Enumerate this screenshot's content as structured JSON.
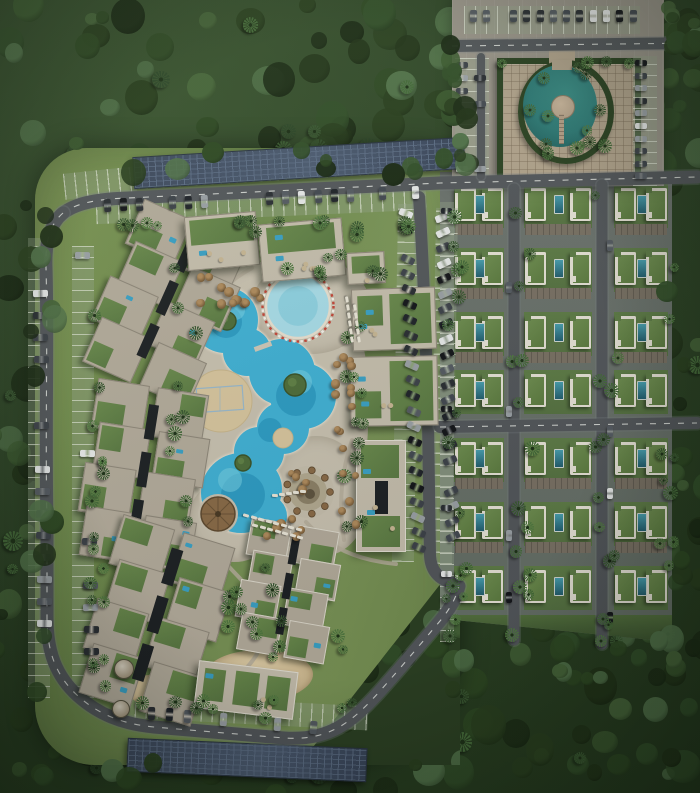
{
  "scene": {
    "width": 700,
    "height": 793
  },
  "palette": {
    "forest_tones": [
      "#223419",
      "#2a401f",
      "#33502a",
      "#3d5c31",
      "#1c2c16",
      "#47663a",
      "#52734a",
      "#2f4a24"
    ],
    "lawn": "#75904f",
    "deck": "#c9c2b1",
    "path": "#b6ae9c",
    "asphalt": "#54585c",
    "asphalt_edge": "#7c8084",
    "road_line": "#e4e6e2",
    "stall_base": "rgba(150,165,140,0.38)",
    "stall_line": "rgba(228,233,218,0.65)",
    "pool_main": "#41b2d6",
    "pool_deep": "#2794bd",
    "pool_light": "#79d2e6",
    "pool_kids": "#a9dde9",
    "pool_kids_deep": "#8fd2e2",
    "pool_rim": "#e9e1d1",
    "kids_ring_red": "#c4473a",
    "kids_ring_white": "#f4f1ea",
    "sand": "#d8c69f",
    "island_green": "#4f6e3b",
    "island_ring": "#3b5429",
    "court_line": "#8fb6d4",
    "roof_beige": "#b4ac9c",
    "roof_light": "#c6bfae",
    "roof_green": "#5b7a44",
    "core_dark": "#1e2225",
    "roof_pool": "#3ba2c6",
    "terrace_dot": "#c8b795",
    "villa_pool": "#2a7083",
    "pond": "#2f7c78",
    "hedge": "#2c4323",
    "plaza": "#b2a48d",
    "pavement": "#9b968b",
    "palapa_dark": "#5f4a30",
    "palapa_mid": "#8a6b48",
    "bar_outer": "#c6bfad",
    "bar_ring": "#b3aa91",
    "bar_inner": "#8d8168",
    "bar_center": "#5f5440",
    "car_colors": [
      "#15171b",
      "#2b2f34",
      "#3e434a",
      "#565c63",
      "#9ba1a6",
      "#e8eaea",
      "#20242a",
      "#444a52"
    ]
  },
  "forest": {
    "seed": 20240601,
    "count": 330,
    "palm_count": 70,
    "fringe_count": 90
  },
  "roads": {
    "paths": [
      {
        "name": "perimeter-top-road",
        "d": "M62,214 C74,204 94,199 128,198 L440,183 L697,177",
        "w": 13,
        "dash": true
      },
      {
        "name": "perimeter-west-south-road",
        "d": "M63,213 C50,224 45,242 46,268 C48,336 45,430 47,525 L47,618 C47,652 56,676 78,696 C98,714 122,724 154,727 L284,738 C330,741 352,722 380,691 C404,664 424,640 440,621 C450,609 456,598 459,586",
        "w": 13,
        "dash": true
      },
      {
        "name": "central-parking-street",
        "d": "M419,197 C423,260 426,340 428,420 L430,556 C431,570 438,579 452,583",
        "w": 12,
        "dash": false
      },
      {
        "name": "entrance-road",
        "d": "M452,46 L700,43",
        "w": 12,
        "dash": true
      },
      {
        "name": "entrance-connector",
        "d": "M481,57 L481,176",
        "w": 8,
        "dash": false
      },
      {
        "name": "villa-street-west",
        "d": "M514,189 L514,640",
        "w": 11,
        "dash": false
      },
      {
        "name": "villa-street-east",
        "d": "M602,185 L602,644",
        "w": 11,
        "dash": false
      },
      {
        "name": "villa-cross-road",
        "d": "M440,427 L697,423",
        "w": 12,
        "dash": true
      }
    ],
    "garden_paths": [
      {
        "d": "M212,545 C232,576 256,586 262,616 C268,642 256,660 240,674"
      },
      {
        "d": "M306,522 C330,548 356,560 396,564"
      },
      {
        "d": "M252,268 C230,280 214,296 206,314"
      },
      {
        "d": "M352,440 C342,470 338,500 344,540"
      },
      {
        "d": "M200,420 C184,440 180,470 190,498"
      }
    ]
  },
  "decks": [
    [
      168,
      262,
      200,
      300,
      "48% 42% 46% 52%"
    ],
    [
      252,
      258,
      118,
      96,
      "50%"
    ],
    [
      272,
      436,
      96,
      120,
      "46% 54% 48% 44%"
    ],
    [
      188,
      478,
      92,
      84,
      "50% 45% 50% 50%"
    ]
  ],
  "pool": {
    "lagoon": [
      [
        225,
        320,
        33
      ],
      [
        247,
        352,
        24
      ],
      [
        282,
        372,
        33
      ],
      [
        303,
        396,
        33
      ],
      [
        283,
        428,
        26
      ],
      [
        259,
        452,
        25
      ],
      [
        249,
        489,
        33
      ],
      [
        266,
        516,
        21
      ],
      [
        241,
        493,
        40
      ]
    ],
    "deep": [
      [
        296,
        396,
        20
      ],
      [
        243,
        495,
        22
      ],
      [
        226,
        322,
        16
      ],
      [
        270,
        430,
        12
      ]
    ],
    "light": [
      [
        235,
        310,
        10
      ],
      [
        300,
        382,
        12
      ],
      [
        230,
        480,
        12
      ]
    ],
    "islands": [
      [
        227,
        321,
        9
      ],
      [
        295,
        385,
        11
      ],
      [
        243,
        463,
        8
      ]
    ],
    "kids": {
      "cx": 298,
      "cy": 306,
      "r": 32,
      "ring_r": 35.5
    },
    "sand": {
      "cx": 221,
      "cy": 401,
      "r": 31
    },
    "court": [
      197,
      387,
      46,
      24
    ],
    "bridge": [
      254,
      344,
      18,
      5,
      -20
    ],
    "palapa": {
      "cx": 218,
      "cy": 514,
      "r": 17
    },
    "bar": {
      "cx": 308,
      "cy": 492,
      "umbrellas": 9,
      "umb_r": 22
    },
    "sand2": {
      "cx": 283,
      "cy": 438,
      "r": 10
    }
  },
  "apartment_clusters": [
    {
      "x": 104,
      "y": 216,
      "w": 122,
      "h": 174,
      "rot": 24,
      "trim": false
    },
    {
      "x": 84,
      "y": 386,
      "w": 118,
      "h": 178,
      "rot": 9,
      "trim": false
    },
    {
      "x": 94,
      "y": 528,
      "w": 124,
      "h": 184,
      "rot": 17,
      "trim": false
    },
    {
      "x": 240,
      "y": 524,
      "w": 94,
      "h": 132,
      "rot": 10,
      "trim": true
    }
  ],
  "slabs": [
    {
      "x": 186,
      "y": 214,
      "w": 70,
      "h": 52,
      "rot": -5,
      "green": [
        [
          0.05,
          0.05,
          0.9,
          0.48
        ]
      ],
      "pools": 1,
      "dots": 3,
      "trim": false
    },
    {
      "x": 260,
      "y": 221,
      "w": 82,
      "h": 56,
      "rot": -5,
      "green": [
        [
          0.08,
          0.05,
          0.84,
          0.46
        ]
      ],
      "pools": 2,
      "dots": 4,
      "trim": false
    },
    {
      "x": 347,
      "y": 252,
      "w": 36,
      "h": 30,
      "rot": -3,
      "green": [
        [
          0.1,
          0.1,
          0.8,
          0.55
        ]
      ],
      "pools": 0,
      "dots": 1,
      "trim": false
    },
    {
      "x": 352,
      "y": 288,
      "w": 82,
      "h": 60,
      "rot": -2,
      "green": [
        [
          0.45,
          0.08,
          0.5,
          0.84
        ],
        [
          0.06,
          0.1,
          0.3,
          0.5
        ]
      ],
      "pools": 2,
      "dots": 2,
      "trim": false
    },
    {
      "x": 350,
      "y": 356,
      "w": 86,
      "h": 68,
      "rot": -1,
      "green": [
        [
          0.45,
          0.06,
          0.5,
          0.88
        ],
        [
          0.05,
          0.5,
          0.3,
          0.4
        ]
      ],
      "pools": 2,
      "dots": 2,
      "trim": false
    },
    {
      "x": 356,
      "y": 440,
      "w": 48,
      "h": 110,
      "rot": 0,
      "green": [
        [
          0.08,
          0.04,
          0.8,
          0.3
        ],
        [
          0.1,
          0.68,
          0.8,
          0.28
        ]
      ],
      "core": [
        0.38,
        0.36,
        0.26,
        0.3
      ],
      "pools": 2,
      "dots": 2,
      "trim": true
    },
    {
      "x": 196,
      "y": 666,
      "w": 98,
      "h": 46,
      "rot": 7,
      "green": [
        [
          0.06,
          0.12,
          0.22,
          0.7
        ],
        [
          0.38,
          0.1,
          0.24,
          0.75
        ],
        [
          0.7,
          0.14,
          0.24,
          0.7
        ]
      ],
      "pools": 1,
      "dots": 2,
      "trim": true
    }
  ],
  "villa_grid": {
    "x": 440,
    "y": 172,
    "w": 232,
    "h": 470,
    "groups": [
      {
        "x": 14,
        "w": 50
      },
      {
        "x": 84,
        "w": 68
      },
      {
        "x": 174,
        "w": 54
      }
    ],
    "rows": [
      16,
      80,
      144,
      202,
      270,
      334,
      398
    ],
    "villa": {
      "w": 21,
      "h": 33
    },
    "bottom_strip_y": 443
  },
  "entrance": {
    "base": [
      452,
      0,
      212,
      186
    ],
    "plaza": [
      497,
      58,
      132,
      114
    ],
    "pond": [
      518,
      60,
      84,
      92
    ],
    "island": [
      551,
      95,
      22
    ],
    "pond_bridge": [
      559,
      114,
      5,
      30
    ],
    "gap": [
      549,
      50,
      26,
      16
    ]
  },
  "parking_bands": [
    {
      "x": 96,
      "y": 194,
      "w": 330,
      "h": 23,
      "rot": -2.5,
      "dir": 90
    },
    {
      "x": 64,
      "y": 170,
      "w": 72,
      "h": 26,
      "rot": -6,
      "dir": 90
    },
    {
      "x": 28,
      "y": 238,
      "w": 22,
      "h": 460,
      "rot": 0,
      "dir": 0
    },
    {
      "x": 72,
      "y": 246,
      "w": 22,
      "h": 452,
      "rot": 0,
      "dir": 0
    },
    {
      "x": 124,
      "y": 700,
      "w": 244,
      "h": 24,
      "rot": 3,
      "dir": 90
    },
    {
      "x": 395,
      "y": 204,
      "w": 22,
      "h": 358,
      "rot": 1,
      "dir": 0
    },
    {
      "x": 433,
      "y": 208,
      "w": 22,
      "h": 356,
      "rot": 1,
      "dir": 0
    },
    {
      "x": 464,
      "y": 6,
      "w": 176,
      "h": 28,
      "rot": 0,
      "dir": 90
    },
    {
      "x": 455,
      "y": 58,
      "w": 34,
      "h": 122,
      "rot": 0,
      "dir": 0
    },
    {
      "x": 633,
      "y": 56,
      "w": 24,
      "h": 130,
      "rot": 0,
      "dir": 0
    },
    {
      "x": 440,
      "y": 202,
      "w": 14,
      "h": 440,
      "rot": 0,
      "dir": 0
    }
  ],
  "car_strips": [
    {
      "x": 104,
      "y": 199,
      "dx": 16.2,
      "dy": -0.7,
      "n": 20,
      "w": 7,
      "h": 13,
      "rot": -3,
      "p": 0.8
    },
    {
      "x": 399,
      "y": 210,
      "dx": 0.6,
      "dy": 15.2,
      "n": 23,
      "w": 14,
      "h": 6.5,
      "rot": 24,
      "p": 0.85
    },
    {
      "x": 435,
      "y": 214,
      "dx": 0.5,
      "dy": 15.2,
      "n": 22,
      "w": 14,
      "h": 6.5,
      "rot": -24,
      "p": 0.8
    },
    {
      "x": 32,
      "y": 246,
      "dx": 0.3,
      "dy": 22,
      "n": 20,
      "w": 15,
      "h": 7,
      "rot": 0,
      "p": 0.5
    },
    {
      "x": 75,
      "y": 252,
      "dx": 0.5,
      "dy": 22,
      "n": 19,
      "w": 15,
      "h": 7,
      "rot": 0,
      "p": 0.4
    },
    {
      "x": 130,
      "y": 705,
      "dx": 18,
      "dy": 1.6,
      "n": 13,
      "w": 7,
      "h": 13,
      "rot": 4,
      "p": 0.65
    },
    {
      "x": 470,
      "y": 10,
      "dx": 13.3,
      "dy": 0,
      "n": 13,
      "w": 6.5,
      "h": 12,
      "rot": 0,
      "p": 0.8
    },
    {
      "x": 456,
      "y": 62,
      "dx": 0,
      "dy": 13,
      "n": 9,
      "w": 12,
      "h": 6,
      "rot": 0,
      "p": 0.75
    },
    {
      "x": 474,
      "y": 62,
      "dx": 0,
      "dy": 13,
      "n": 9,
      "w": 12,
      "h": 6,
      "rot": 0,
      "p": 0.55
    },
    {
      "x": 635,
      "y": 60,
      "dx": 0,
      "dy": 12.6,
      "n": 10,
      "w": 12,
      "h": 6,
      "rot": 0,
      "p": 0.85
    },
    {
      "x": 441,
      "y": 208,
      "dx": 0,
      "dy": 33,
      "n": 13,
      "w": 11,
      "h": 5.5,
      "rot": 0,
      "p": 0.5
    },
    {
      "x": 506,
      "y": 220,
      "dx": 0,
      "dy": 62,
      "n": 7,
      "w": 5.5,
      "h": 11,
      "rot": 0,
      "p": 0.45
    },
    {
      "x": 607,
      "y": 240,
      "dx": 0,
      "dy": 62,
      "n": 7,
      "w": 5.5,
      "h": 11,
      "rot": 0,
      "p": 0.45
    }
  ],
  "solar_strips": [
    [
      133,
      147,
      330,
      30,
      -3.5
    ],
    [
      127,
      743,
      238,
      32,
      2.5
    ]
  ],
  "palm_bands": [
    {
      "x": 98,
      "y": 214,
      "w": 320,
      "h": 14,
      "n": 16
    },
    {
      "x": 84,
      "y": 244,
      "w": 16,
      "h": 450,
      "n": 18
    },
    {
      "x": 160,
      "y": 262,
      "w": 30,
      "h": 260,
      "n": 10
    },
    {
      "x": 336,
      "y": 310,
      "w": 26,
      "h": 220,
      "n": 12
    },
    {
      "x": 196,
      "y": 548,
      "w": 150,
      "h": 110,
      "n": 14
    },
    {
      "x": 120,
      "y": 690,
      "w": 240,
      "h": 28,
      "n": 10
    },
    {
      "x": 440,
      "y": 196,
      "w": 16,
      "h": 440,
      "n": 10
    },
    {
      "x": 500,
      "y": 190,
      "w": 26,
      "h": 446,
      "n": 14
    },
    {
      "x": 588,
      "y": 190,
      "w": 26,
      "h": 446,
      "n": 14
    },
    {
      "x": 650,
      "y": 190,
      "w": 22,
      "h": 446,
      "n": 10
    },
    {
      "x": 524,
      "y": 64,
      "w": 78,
      "h": 84,
      "n": 6
    },
    {
      "x": 496,
      "y": 56,
      "w": 136,
      "h": 8,
      "n": 5
    },
    {
      "x": 250,
      "y": 246,
      "w": 150,
      "h": 30,
      "n": 8
    },
    {
      "x": 430,
      "y": 560,
      "w": 40,
      "h": 60,
      "n": 6
    }
  ],
  "umbrella_clusters": [
    {
      "x": 196,
      "y": 270,
      "w": 72,
      "h": 30,
      "n": 13
    },
    {
      "x": 330,
      "y": 326,
      "w": 26,
      "h": 196,
      "n": 17
    },
    {
      "x": 250,
      "y": 515,
      "w": 56,
      "h": 22,
      "n": 7
    },
    {
      "x": 287,
      "y": 468,
      "w": 26,
      "h": 18,
      "n": 4
    }
  ],
  "lounger_strips": [
    {
      "x": 243,
      "y": 514,
      "dx": 7.5,
      "dy": 2,
      "n": 8,
      "rot": 15
    },
    {
      "x": 252,
      "y": 524,
      "dx": 7.5,
      "dy": 2,
      "n": 7,
      "rot": 15
    },
    {
      "x": 272,
      "y": 494,
      "dx": 7,
      "dy": -1,
      "n": 5,
      "rot": 5
    },
    {
      "x": 344,
      "y": 298,
      "dx": 1,
      "dy": 8,
      "n": 6,
      "rot": 80
    },
    {
      "x": 352,
      "y": 306,
      "dx": 1,
      "dy": 8,
      "n": 5,
      "rot": 80
    }
  ],
  "features": {
    "kiosks": [
      [
        123,
        668,
        9
      ],
      [
        120,
        708,
        8
      ]
    ],
    "sand_patches": [
      [
        128,
        676,
        68,
        34,
        8
      ],
      [
        205,
        650,
        108,
        52,
        -4
      ]
    ]
  }
}
